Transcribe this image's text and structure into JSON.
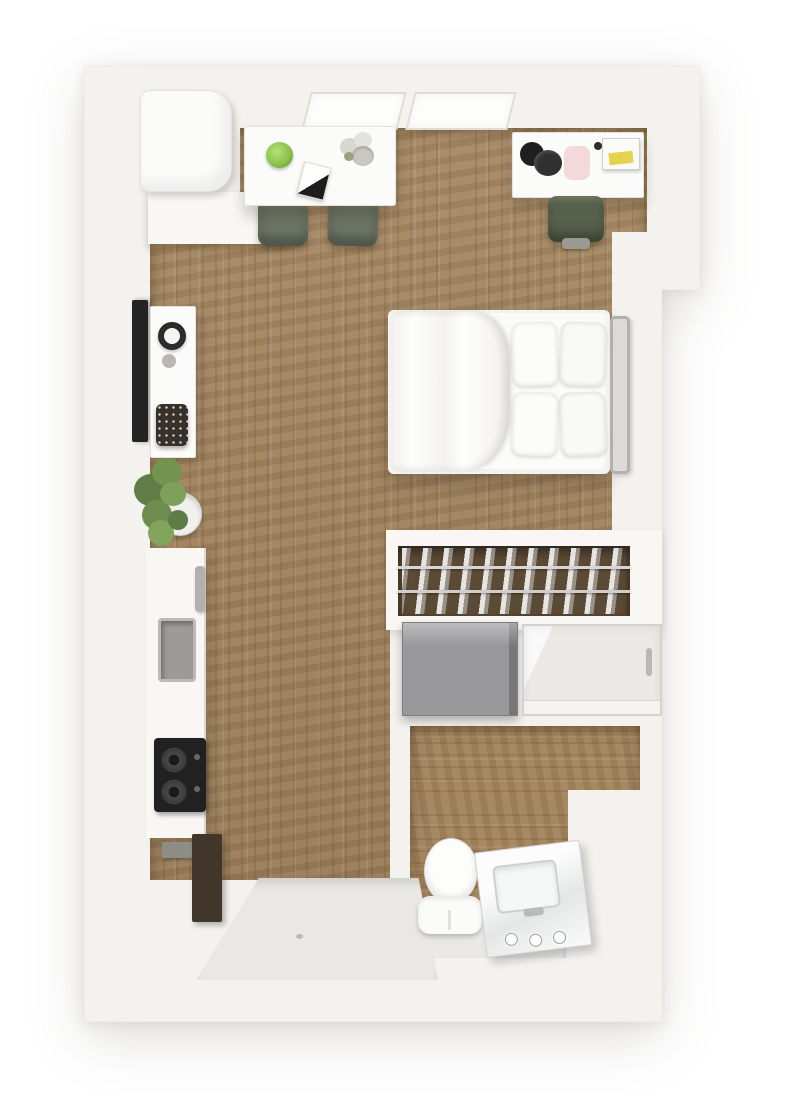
{
  "image": {
    "type": "3d-floor-plan-rendering",
    "view": "top-down",
    "subject": "studio-apartment",
    "visible_text": ""
  },
  "colors": {
    "background": "#ffffff",
    "wall": "#f3f2ef",
    "wall_light": "#f8f7f4",
    "wood_floor": "#a3845d",
    "closet_interior": "#584631",
    "entry_tile": "#e9e8e4",
    "dining_chair": "#6c7566",
    "desk_chair": "#57614b",
    "plant_green": "#6f8f55",
    "salad_green": "#8bc34a",
    "tv_black": "#232323",
    "stove_black": "#212121",
    "appliance_gray": "#98989a",
    "sink_gray": "#9c9b99",
    "cabinet_brown": "#42352a",
    "laptop_paper_yellow": "#e5d24d",
    "desk_mat_pink": "#f2d2d3",
    "metal": "#b3b1ae",
    "white_furniture": "#fbfbfa"
  },
  "rooms": [
    {
      "name": "living-dining-area",
      "floor": "wood"
    },
    {
      "name": "sleeping-area",
      "floor": "wood"
    },
    {
      "name": "kitchen",
      "floor": "wood"
    },
    {
      "name": "closet",
      "floor": "wood"
    },
    {
      "name": "bathroom",
      "floor": "wood"
    },
    {
      "name": "entry",
      "floor": "light-tile"
    }
  ],
  "furniture": [
    {
      "name": "refrigerator",
      "room": "kitchen-nook"
    },
    {
      "name": "window",
      "count": 2,
      "wall": "top"
    },
    {
      "name": "dining-table",
      "items_on_top": [
        "salad-bowl",
        "magazine",
        "flower-vase"
      ]
    },
    {
      "name": "dining-chair",
      "count": 2,
      "color": "sage-green"
    },
    {
      "name": "desk",
      "items_on_top": [
        "headset",
        "pink-mat",
        "laptop-with-yellow-paper"
      ]
    },
    {
      "name": "desk-chair",
      "color": "dark-green"
    },
    {
      "name": "queen-bed",
      "pillows": 4,
      "headboard": "metal-frame"
    },
    {
      "name": "wall-mounted-tv"
    },
    {
      "name": "media-console",
      "items_on_top": [
        "round-clock-decor",
        "patterned-basket"
      ]
    },
    {
      "name": "potted-plant"
    },
    {
      "name": "kitchen-counter",
      "items": [
        "sink",
        "faucet",
        "two-burner-stove"
      ]
    },
    {
      "name": "dark-cabinet"
    },
    {
      "name": "closet-rail-with-hanging-clothes"
    },
    {
      "name": "washer-dryer"
    },
    {
      "name": "glass-shower"
    },
    {
      "name": "toilet"
    },
    {
      "name": "vanity-sink",
      "items": [
        "basin",
        "faucet-knobs"
      ]
    }
  ]
}
